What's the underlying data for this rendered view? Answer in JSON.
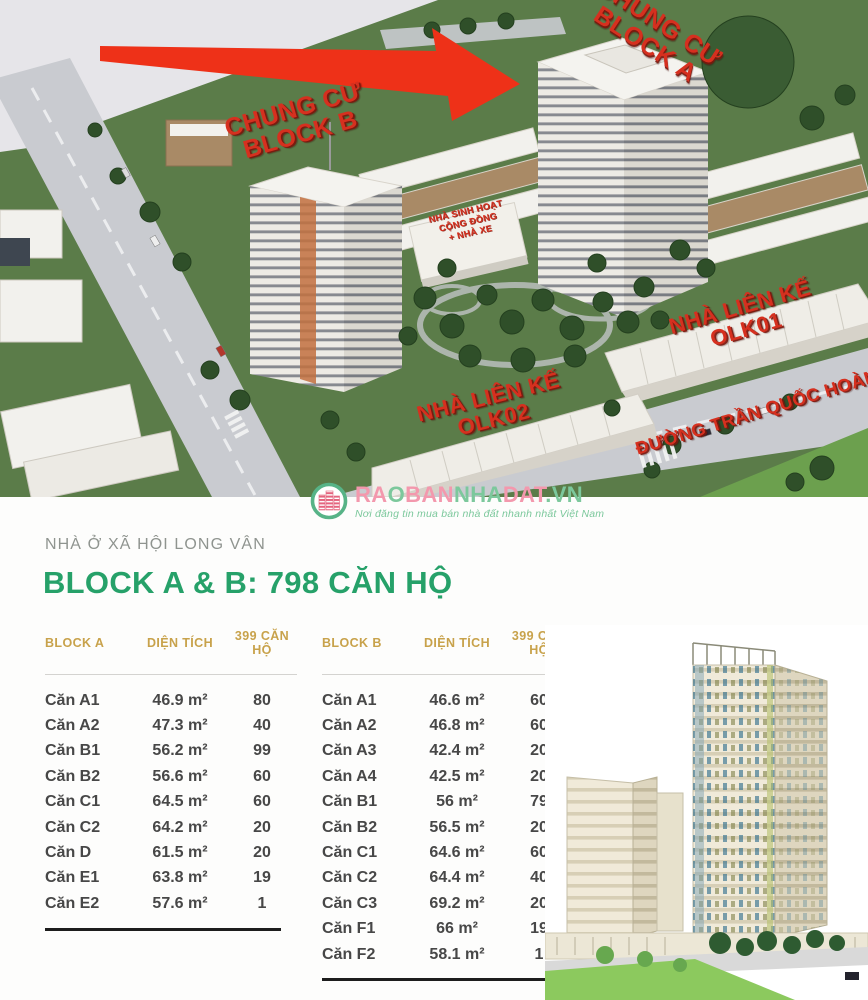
{
  "masterplan": {
    "labels": {
      "block_a": "CHUNG CƯ\nBLOCK A",
      "block_b": "CHUNG CƯ\nBLOCK B",
      "community": "NHÀ SINH HOẠT\nCỘNG ĐỒNG\n+ NHÀ XE",
      "olk01": "NHÀ LIÊN KẾ\nOLK01",
      "olk02": "NHÀ LIÊN KẾ\nOLK02",
      "street": "ĐƯỜNG TRẦN QUỐC HOÀN"
    }
  },
  "logo": {
    "segments": [
      {
        "text": "RA",
        "color": "#f398ad"
      },
      {
        "text": "O",
        "color": "#7cc89c"
      },
      {
        "text": "BAN",
        "color": "#f398ad"
      },
      {
        "text": "NHA",
        "color": "#7cc89c"
      },
      {
        "text": "DAT",
        "color": "#f398ad"
      },
      {
        "text": ".VN",
        "color": "#7cc89c"
      }
    ],
    "tagline": "Nơi đăng tin mua bán nhà đất nhanh nhất Việt Nam"
  },
  "info": {
    "project_label": "NHÀ Ở XÃ HỘI LONG VÂN",
    "headline": "BLOCK A & B: 798 CĂN HỘ",
    "tables": [
      {
        "block": "BLOCK A",
        "area_header": "DIỆN TÍCH",
        "units_header": "399 CĂN HỘ",
        "rows": [
          [
            "Căn A1",
            "46.9 m²",
            "80"
          ],
          [
            "Căn A2",
            "47.3 m²",
            "40"
          ],
          [
            "Căn B1",
            "56.2 m²",
            "99"
          ],
          [
            "Căn B2",
            "56.6 m²",
            "60"
          ],
          [
            "Căn C1",
            "64.5 m²",
            "60"
          ],
          [
            "Căn C2",
            "64.2 m²",
            "20"
          ],
          [
            "Căn D",
            "61.5 m²",
            "20"
          ],
          [
            "Căn E1",
            "63.8 m²",
            "19"
          ],
          [
            "Căn E2",
            "57.6 m²",
            "1"
          ]
        ]
      },
      {
        "block": "BLOCK B",
        "area_header": "DIỆN TÍCH",
        "units_header": "399 CĂN HỘ",
        "rows": [
          [
            "Căn A1",
            "46.6 m²",
            "60"
          ],
          [
            "Căn A2",
            "46.8 m²",
            "60"
          ],
          [
            "Căn A3",
            "42.4 m²",
            "20"
          ],
          [
            "Căn A4",
            "42.5 m²",
            "20"
          ],
          [
            "Căn B1",
            "56 m²",
            "79"
          ],
          [
            "Căn B2",
            "56.5 m²",
            "20"
          ],
          [
            "Căn C1",
            "64.6 m²",
            "60"
          ],
          [
            "Căn C2",
            "64.4 m²",
            "40"
          ],
          [
            "Căn C3",
            "69.2 m²",
            "20"
          ],
          [
            "Căn F1",
            "66 m²",
            "19"
          ],
          [
            "Căn F2",
            "58.1 m²",
            "1"
          ]
        ]
      }
    ]
  },
  "colors": {
    "headline_green": "#26a169",
    "header_gold": "#c8a24b",
    "label_red": "#d6301f",
    "arrow_red": "#ee3118",
    "brand_pink": "#f398ad",
    "brand_green": "#7cc89c"
  }
}
